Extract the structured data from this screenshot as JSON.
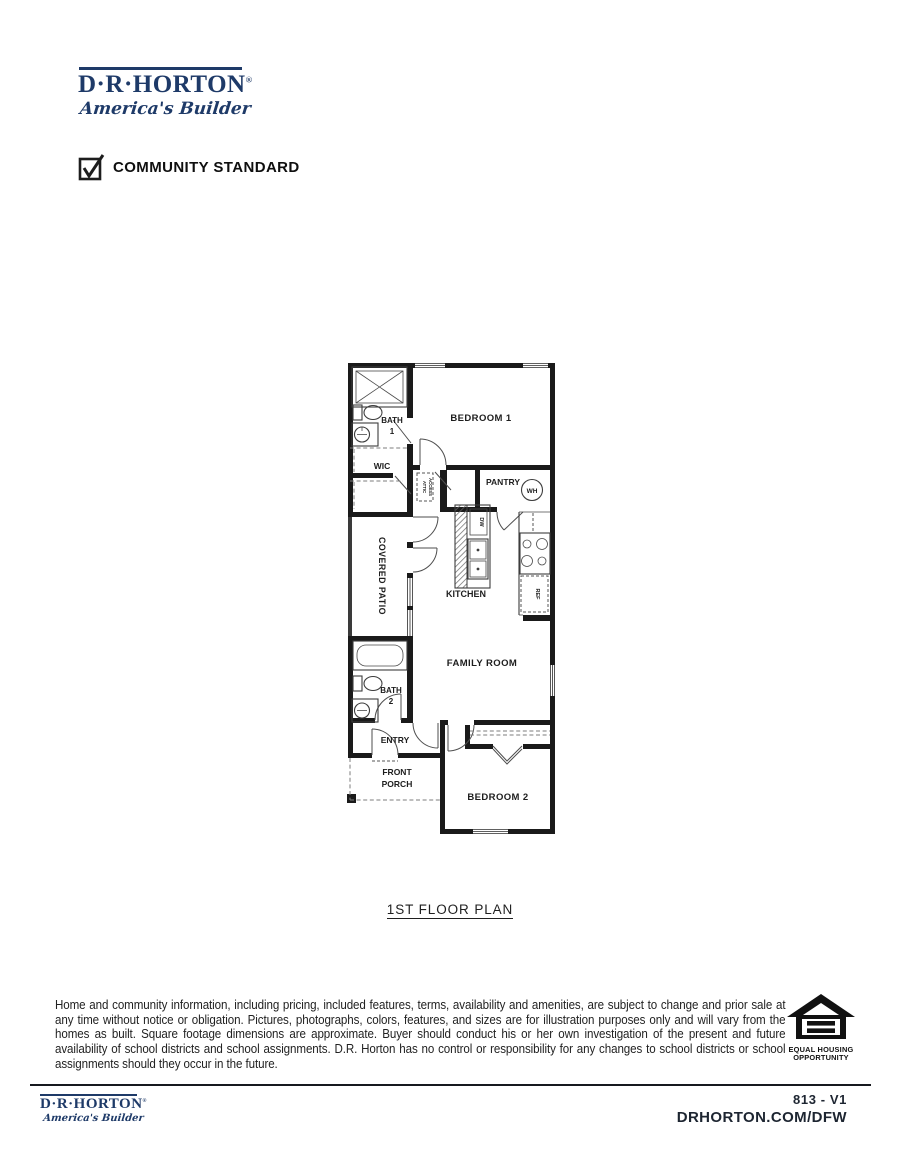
{
  "brand": {
    "name": "D·R·HORTON",
    "registered": "®",
    "tagline": "America's Builder"
  },
  "header": {
    "community_standard_label": "COMMUNITY STANDARD"
  },
  "floor_plan": {
    "caption": "1ST FLOOR PLAN",
    "rooms": {
      "bedroom1": "BEDROOM 1",
      "bath1_line1": "BATH",
      "bath1_line2": "1",
      "wic": "WIC",
      "attic_line1": "ATTIC",
      "attic_line2": "ACCESS",
      "pantry": "PANTRY",
      "water_heater": "WH",
      "dishwasher": "DW",
      "kitchen": "KITCHEN",
      "refrigerator": "REF",
      "covered_patio": "COVERED PATIO",
      "family_room": "FAMILY ROOM",
      "bath2_line1": "BATH",
      "bath2_line2": "2",
      "entry": "ENTRY",
      "front_porch_line1": "FRONT",
      "front_porch_line2": "PORCH",
      "bedroom2": "BEDROOM 2"
    }
  },
  "disclaimer": "Home and community information, including pricing, included features, terms, availability and amenities, are subject to change and prior sale at any time without notice or obligation. Pictures, photographs, colors, features, and sizes are for illustration purposes only and will vary from the homes as built. Square footage dimensions are approximate. Buyer should conduct his or her own investigation of the present and future availability of school districts and school assignments. D.R. Horton has no control or responsibility for any changes to school districts or school assignments should they occur in the future.",
  "equal_housing": {
    "line1": "EQUAL HOUSING",
    "line2": "OPPORTUNITY"
  },
  "footer": {
    "plan_code": "813 - V1",
    "website": "DRHORTON.COM/DFW"
  },
  "colors": {
    "brand_navy": "#1e3a68",
    "wall_black": "#1a1a1a"
  }
}
